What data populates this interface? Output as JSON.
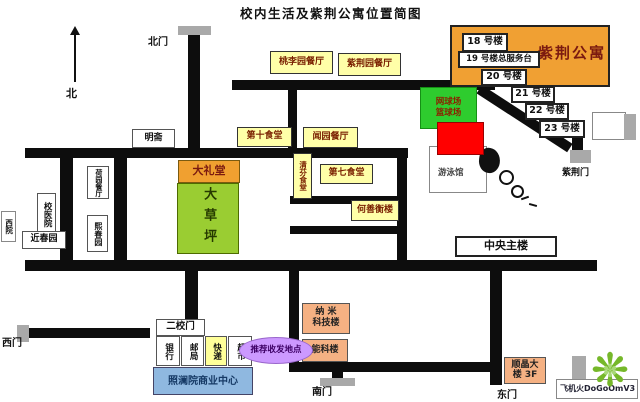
{
  "title": "校内生活及紫荆公寓位置简图",
  "compass": {
    "north": "北"
  },
  "gates": {
    "north": "北门",
    "west": "西门",
    "south": "南门",
    "east": "东门",
    "zijing": "紫荆门",
    "second": "二校门"
  },
  "apartments": {
    "name": "紫荆公寓",
    "b18": "18 号楼",
    "b19": "19 号楼总服务台",
    "b20": "20 号楼",
    "b21": "21 号楼",
    "b22": "22 号楼",
    "b23": "23 号楼"
  },
  "dining": {
    "taoliyuan": "桃李园餐厅",
    "zijingyuan": "紫荆园餐厅",
    "wenyuan": "闻园餐厅",
    "canteen10": "第十食堂",
    "canteen7": "第七食堂",
    "qingfen": "清芬食堂",
    "heyuan": "荷园餐厅"
  },
  "buildings": {
    "mingzhai": "明斋",
    "auditorium": "大礼堂",
    "lawn": "大草坪",
    "hospital": "校医院",
    "jinchunyuan": "近春园",
    "xichunyuan": "熙春园",
    "xiyuan": "西院",
    "heshanheng": "何善衡楼",
    "main_building": "中央主楼",
    "nano_line1": "纳 米",
    "nano_line2": "科技楼",
    "energy": "能科楼",
    "shunjing_line1": "顺晶大",
    "shunjing_line2": "楼 3F"
  },
  "sports": {
    "court_line1": "网球场",
    "court_line2": "篮球场",
    "natatorium": "游泳馆"
  },
  "commerce": {
    "bank": "银行",
    "post": "邮局",
    "express": "快递",
    "market": "超市",
    "center": "照澜院商业中心",
    "recommend": "推荐收发地点"
  },
  "watermark": {
    "text": "飞机火DoGoOmV3"
  },
  "colors": {
    "apartment_orange": "#F0A033",
    "canteen_yellow": "#FFFFA8",
    "lawn_green": "#9ACD32",
    "court_green": "#2ECC2E",
    "alert_red": "#FF0000",
    "commercial_blue": "#8FB8E0",
    "highlight_purple": "#CC99FF",
    "building_tan": "#F5B183",
    "road_black": "#0D0D0D",
    "gate_gray": "#A9A9A9",
    "flower_green": "#76B82A"
  }
}
